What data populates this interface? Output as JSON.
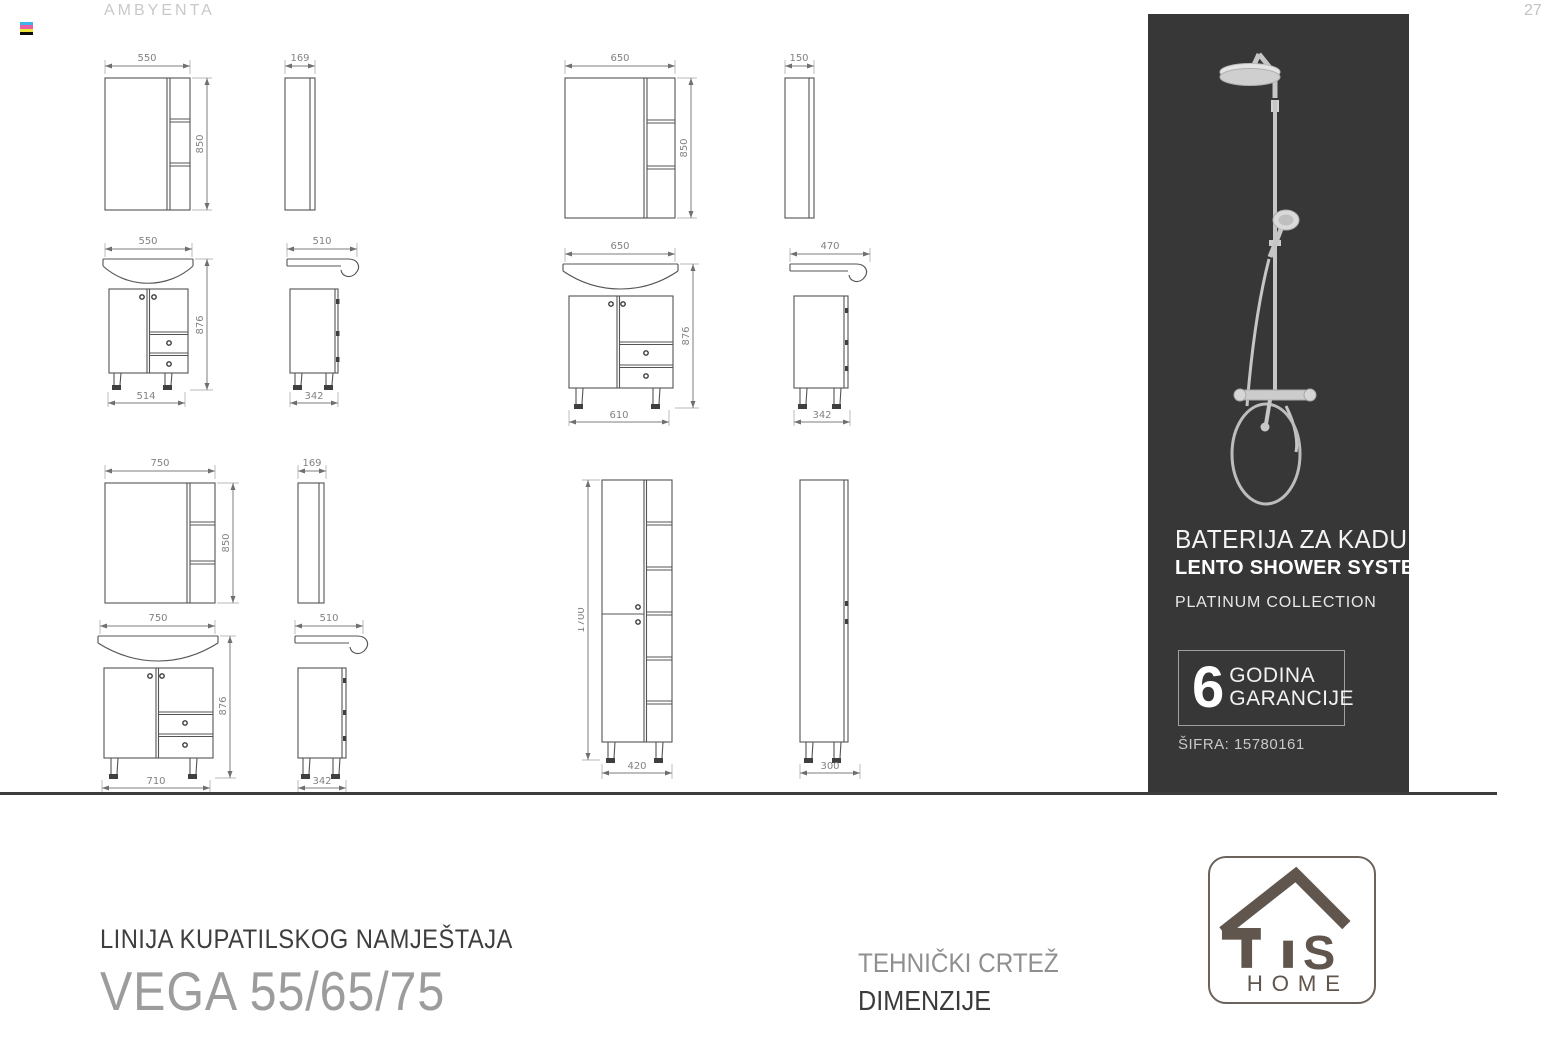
{
  "header": {
    "brand": "AMBYENTA",
    "page_number": "27"
  },
  "dims": {
    "m55": {
      "w": "550",
      "h": "850",
      "d": "169"
    },
    "v55": {
      "w": "550",
      "h": "876",
      "base": "514",
      "side": "510",
      "side_base": "342"
    },
    "m65": {
      "w": "650",
      "h": "850",
      "d": "150"
    },
    "v65": {
      "w": "650",
      "h": "876",
      "base": "610",
      "side": "470",
      "side_base": "342"
    },
    "m75": {
      "w": "750",
      "h": "850",
      "d": "169"
    },
    "v75": {
      "w": "750",
      "h": "876",
      "base": "710",
      "side": "510",
      "side_base": "342"
    },
    "tall": {
      "h": "1700",
      "base": "420",
      "side_base": "300"
    }
  },
  "panel": {
    "title": "BATERIJA ZA KADU",
    "subtitle": "LENTO SHOWER SYSTEM",
    "collection": "PLATINUM COLLECTION",
    "warranty_number": "6",
    "warranty_line1": "GODINA",
    "warranty_line2": "GARANCIJE",
    "sku": "ŠIFRA: 15780161"
  },
  "logo": {
    "s": "S",
    "home": "HOME"
  },
  "footer": {
    "series_label": "LINIJA KUPATILSKOG NAMJEŠTAJA",
    "product_name": "VEGA 55/65/75",
    "center_line1": "TEHNIČKI CRTEŽ",
    "center_line2": "DIMENZIJE"
  },
  "colors": {
    "panel_background": "#373737",
    "drawing_line": "#545454",
    "dimension_text": "#828282",
    "logo_color": "#60564e",
    "separator": "#3c3c3c"
  }
}
